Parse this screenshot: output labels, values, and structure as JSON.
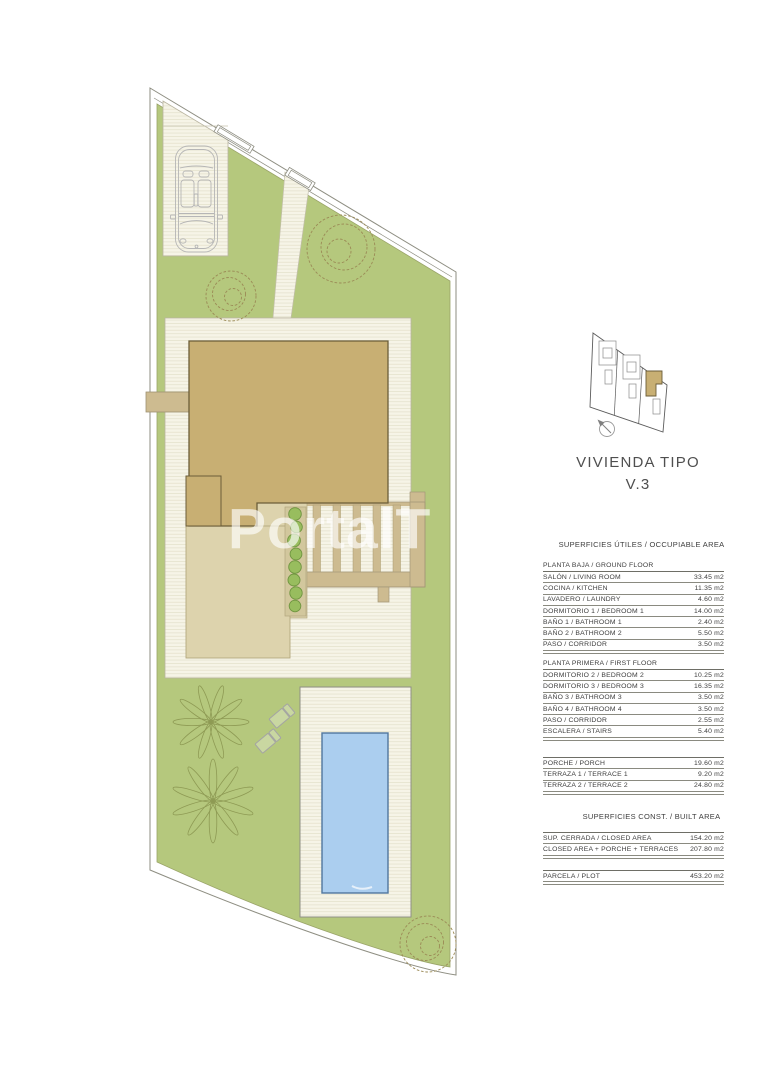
{
  "document": {
    "watermark": "PortalT",
    "title_line1": "VIVIENDA TIPO",
    "title_line2": "V.3"
  },
  "colors": {
    "lawn_green": "#b5c87d",
    "roof_tan": "#c8af73",
    "terrace_beige": "#ddd3ad",
    "pergola_tan": "#cdbb90",
    "pool_blue": "#abceef",
    "deck_cream": "#f6f4e7",
    "shrub_green": "#98bd5e",
    "watermark_white": "#ffffff"
  },
  "tables": {
    "occupiable_header": "SUPERFICIES ÚTILES / OCCUPIABLE AREA",
    "built_header": "SUPERFICIES  CONST. / BUILT AREA",
    "ground_floor": {
      "section": "PLANTA BAJA / GROUND FLOOR",
      "rows": [
        {
          "label": "SALÓN / LIVING ROOM",
          "value": "33.45 m2"
        },
        {
          "label": "COCINA / KITCHEN",
          "value": "11.35 m2"
        },
        {
          "label": "LAVADERO / LAUNDRY",
          "value": "4.60 m2"
        },
        {
          "label": "DORMITORIO 1 /  BEDROOM 1",
          "value": "14.00 m2"
        },
        {
          "label": "BAÑO 1 / BATHROOM 1",
          "value": "2.40 m2"
        },
        {
          "label": "BAÑO 2 / BATHROOM 2",
          "value": "5.50 m2"
        },
        {
          "label": "PASO / CORRIDOR",
          "value": "3.50 m2"
        }
      ]
    },
    "first_floor": {
      "section": "PLANTA PRIMERA / FIRST FLOOR",
      "rows": [
        {
          "label": "DORMITORIO 2 / BEDROOM 2",
          "value": "10.25 m2"
        },
        {
          "label": "DORMITORIO 3 / BEDROOM 3",
          "value": "16.35 m2"
        },
        {
          "label": "BAÑO 3 / BATHROOM 3",
          "value": "3.50 m2"
        },
        {
          "label": "BAÑO 4 / BATHROOM 4",
          "value": "3.50 m2"
        },
        {
          "label": "PASO / CORRIDOR",
          "value": "2.55 m2"
        },
        {
          "label": "ESCALERA / STAIRS",
          "value": "5.40 m2"
        }
      ]
    },
    "outdoor": {
      "rows": [
        {
          "label": "PORCHE / PORCH",
          "value": "19.60 m2"
        },
        {
          "label": "TERRAZA 1 / TERRACE 1",
          "value": "9.20 m2"
        },
        {
          "label": "TERRAZA 2 / TERRACE 2",
          "value": "24.80 m2"
        }
      ]
    },
    "built": {
      "rows": [
        {
          "label": "SUP. CERRADA / CLOSED AREA",
          "value": "154.20 m2"
        },
        {
          "label": "CLOSED AREA + PORCHE + TERRACES",
          "value": "207.80 m2"
        }
      ]
    },
    "plot": {
      "rows": [
        {
          "label": "PARCELA / PLOT",
          "value": "453.20 m2"
        }
      ]
    }
  }
}
